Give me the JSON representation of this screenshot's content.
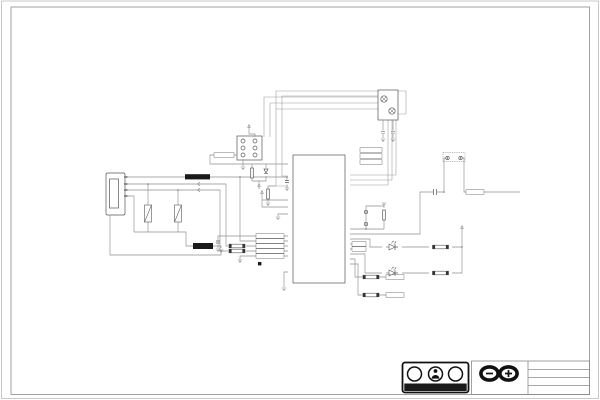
{
  "frame": {
    "columns": [
      "1",
      "2",
      "3",
      "4",
      "5",
      "6",
      "7",
      "8"
    ],
    "rows": [
      "A",
      "B",
      "C",
      "D",
      "E"
    ]
  },
  "title_block": {
    "author": "Arturo Guadalupi",
    "title": "MEGA2560_Rev3e",
    "date": "23.01.2019 17:07:18",
    "sheet": "Sheet: 2/2"
  },
  "branding": {
    "logo_text": "ARDUINO",
    "cc": "CC",
    "by": "BY",
    "sa": "SA",
    "sa_glyph": "↺",
    "reg": "®"
  },
  "disclaimer": {
    "col1": "Reference Designs ARE PROVIDED \"AS IS\" AND \"WITH ALL FAULTS\". Arduino SA DISCLAIMS ALL OTHER WARRANTIES, EXPRESS OR IMPLIED, REGARDING PRODUCTS, INCLUDING BUT NOT LIMITED TO, ANY IMPLIED WARRANTIES OF MERCHANTABILITY OR FITNESS FOR A PARTICULAR PURPOSE",
    "col2": "Arduino SA may make changes to specifications and product descriptions at any time, without notice. The Customer must not rely on the absence or characteristics of any features or instructions marked \"reserved\" or \"undefined\". Arduino reserves these for future definition. ARDUINO related brands and logos cannot be used without owner's formal permission"
  },
  "schematic": {
    "ic4": {
      "ref": "IC4",
      "part": "ATMEGA16U2-MU",
      "left_pins": [
        {
          "num": "24",
          "name": "RESET(PC1/DW)"
        },
        {
          "num": "2",
          "name": "XTAL2(PC0)"
        },
        {
          "num": "1",
          "name": "XTAL1"
        },
        {
          "num": "32",
          "name": "AVCC"
        },
        {
          "num": "4",
          "name": "VCC"
        },
        {
          "num": "3",
          "name": "GND"
        },
        {
          "num": "27",
          "name": "UCAP"
        },
        {
          "num": "31",
          "name": "UVCC"
        },
        {
          "num": "30",
          "name": "D-"
        },
        {
          "num": "29",
          "name": "D+"
        },
        {
          "num": "28",
          "name": "UGND"
        },
        {
          "num": "33",
          "name": "PAD"
        }
      ],
      "right_pins": [
        {
          "num": "21",
          "name": "(PCINT7/OC0A/OC1C)PB7"
        },
        {
          "num": "20",
          "name": "(PCINT6)PB6"
        },
        {
          "num": "19",
          "name": "(PCINT5)PB5"
        },
        {
          "num": "18",
          "name": "(T1/PCINT4)PB4"
        },
        {
          "num": "17",
          "name": "(PDO/MISO/PCINT3)PB3"
        },
        {
          "num": "16",
          "name": "(PDI/MOSI/PCINT2)PB2"
        },
        {
          "num": "15",
          "name": "(SCLK/PCINT1)PB1"
        },
        {
          "num": "14",
          "name": "(SS/PCINT0)PB0"
        },
        {
          "num": "22",
          "name": "(INT4/ICP1/CLKO)PC7"
        },
        {
          "num": "23",
          "name": "(OC1A/PCINT8)PC6"
        },
        {
          "num": "25",
          "name": "(PCINT9/OC1B)PC5"
        },
        {
          "num": "26",
          "name": "(PCINT10)PC4"
        },
        {
          "num": "5",
          "name": "(AIN2/PCINT11)PC2"
        },
        {
          "num": "13",
          "name": "(OC0B/INT7/HWB)PD7"
        },
        {
          "num": "12",
          "name": "(INT6/AIN5)PD6"
        },
        {
          "num": "11",
          "name": "(XCK/AIN4/PCINT12)PD5"
        },
        {
          "num": "10",
          "name": "(INT5/AIN3)PD4"
        },
        {
          "num": "9",
          "name": "(TXD1/INT3)PD3"
        },
        {
          "num": "8",
          "name": "(RXD1/AIN1/INT2)PD2"
        },
        {
          "num": "7",
          "name": "(AIN0/INT1)PD1"
        },
        {
          "num": "6",
          "name": "(OC0B/INT0)PD0"
        }
      ]
    },
    "usb": {
      "ref": "X2",
      "shield": "USHIELD"
    },
    "fuse": {
      "ref": "F1",
      "part": "MF-MSMF050-2 500mA"
    },
    "varistors": {
      "z1": "Z1",
      "z2": "Z2",
      "part": "CG0603MLC-05E"
    },
    "ferrite": {
      "ref": "L1",
      "part": "MH2029-300Y"
    },
    "icsp": {
      "ref": "ICSP1",
      "label": "ICSP",
      "res": "1K",
      "diode": "CD1206-S01575"
    },
    "crystal": {
      "ref": "Y2",
      "value": "16MHz",
      "r2_ref": "R2",
      "r2_val": "1M",
      "c5": "C5 22p",
      "c7": "C7 22p"
    },
    "caps": {
      "c4": "C4",
      "c4_val": "100n",
      "c10": "C10",
      "c10_val": "100nF",
      "c13": "C13",
      "c13_val": "100n"
    },
    "jumpers": {
      "reset_en": "RESET-EN",
      "usb_boot": "USB boot en"
    },
    "leds": {
      "tx": "TX",
      "rx": "RX",
      "color_tx": "Yellow",
      "color_rx": "Yellow",
      "rn4c": "RN4C 1K",
      "rn4d": "RN4D 1K",
      "rn4b": "RN4B 1K",
      "rn4a": "RN4A 1K"
    },
    "nets": {
      "xvcc": "XVCC",
      "usbvcc": "USBVCC",
      "usbdm": "USBDM",
      "usbdp": "USBDP",
      "ucap": "UCAP",
      "rdm": "RD-",
      "rdp": "RD+",
      "ugnd": "UGND",
      "p5v": "+5V",
      "gnd": "GND",
      "ground": "GROUND",
      "miso2": "MISO2",
      "mosi2": "MOSI2",
      "sck2": "SCK2",
      "reset2": "RESET2",
      "tx1": "TX1",
      "rx1": "RX1",
      "m8rxd": "M8RXD",
      "m8txd": "M8TXD",
      "reset": "RESET",
      "r22": "22R"
    }
  }
}
